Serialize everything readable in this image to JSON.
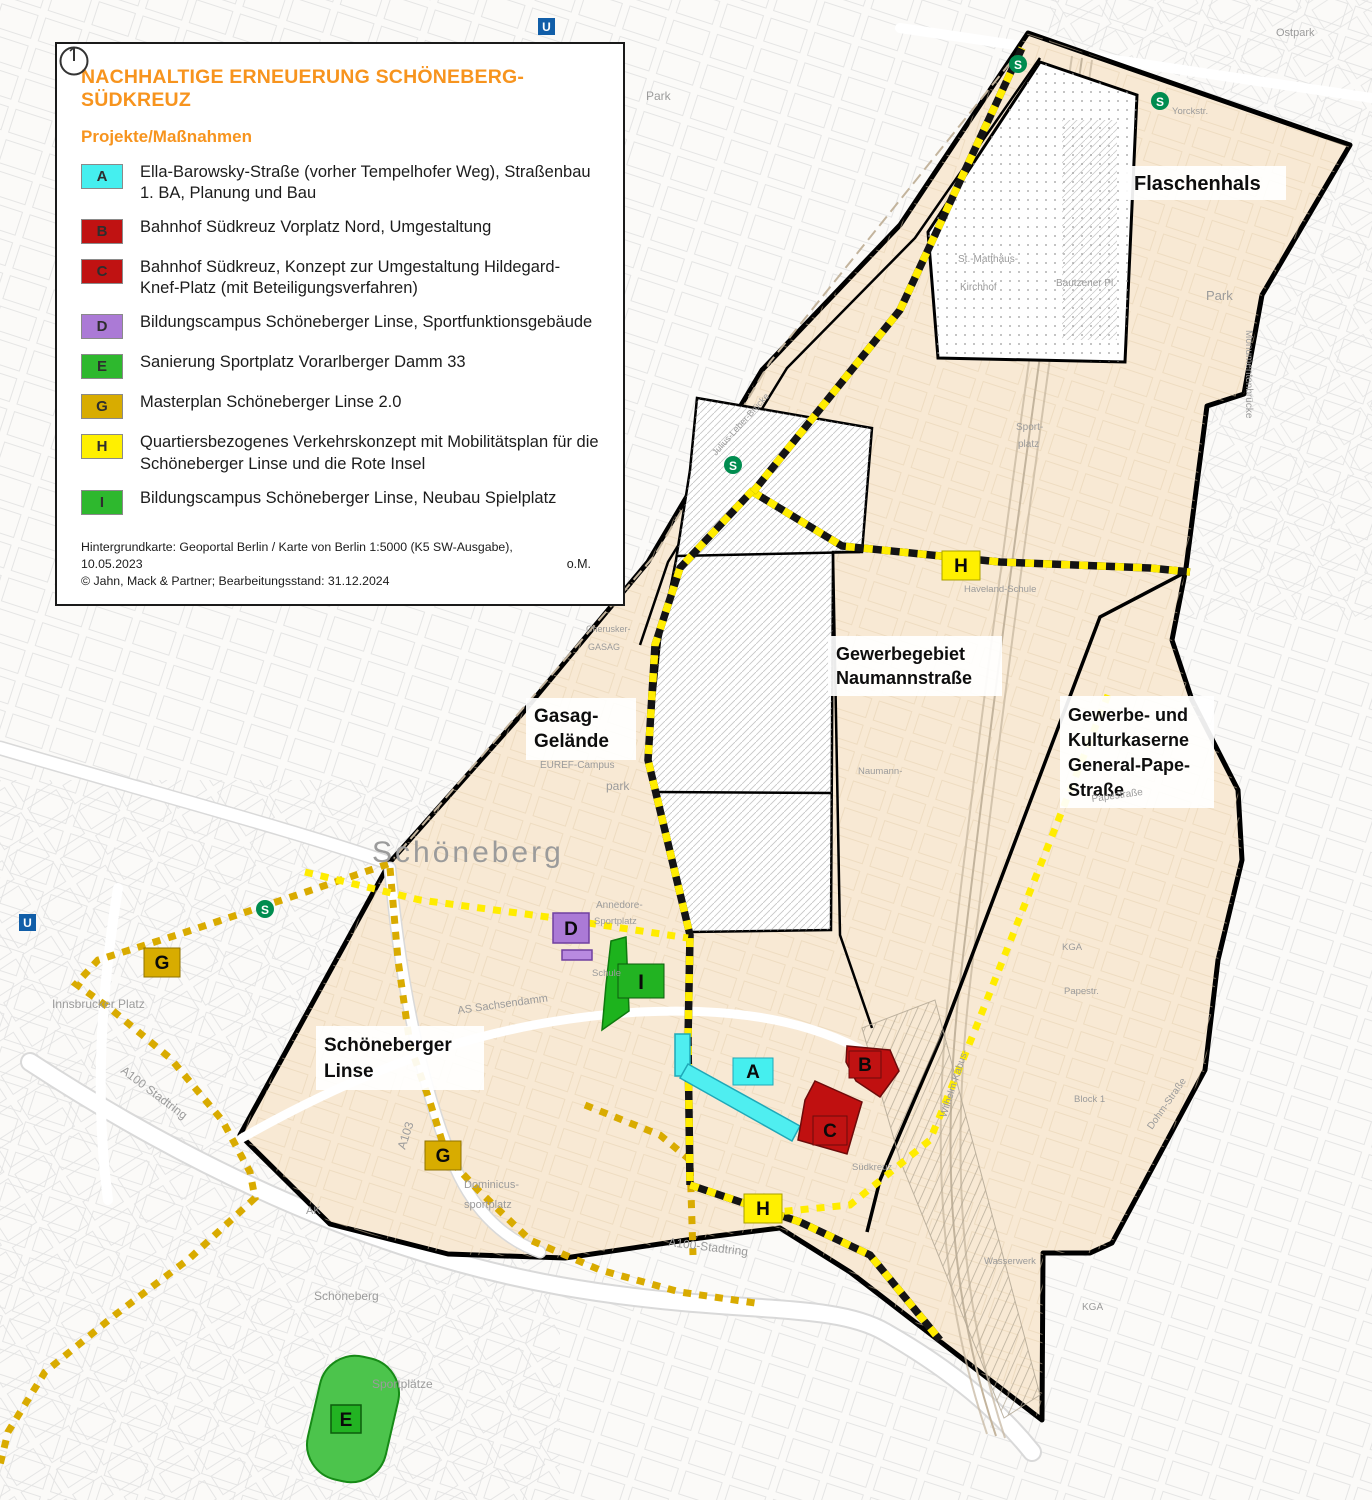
{
  "legend": {
    "title": "NACHHALTIGE ERNEUERUNG SCHÖNEBERG-SÜDKREUZ",
    "title_color": "#F7941E",
    "subtitle": "Projekte/Maßnahmen",
    "items": [
      {
        "letter": "A",
        "color": "#45EFEF",
        "label": "Ella-Barowsky-Straße (vorher Tempelhofer Weg), Straßenbau 1. BA, Planung und Bau"
      },
      {
        "letter": "B",
        "color": "#C01212",
        "label": "Bahnhof Südkreuz Vorplatz Nord, Umgestaltung"
      },
      {
        "letter": "C",
        "color": "#C01212",
        "label": "Bahnhof Südkreuz, Konzept zur Umgestaltung Hildegard-Knef-Platz (mit Beteiligungsverfahren)"
      },
      {
        "letter": "D",
        "color": "#AB7AD6",
        "label": "Bildungscampus Schöneberger Linse, Sportfunktionsgebäude"
      },
      {
        "letter": "E",
        "color": "#2EB82E",
        "label": "Sanierung Sportplatz Vorarlberger Damm 33"
      },
      {
        "letter": "G",
        "color": "#D8AC00",
        "label": "Masterplan Schöneberger Linse 2.0"
      },
      {
        "letter": "H",
        "color": "#FFF000",
        "label": "Quartiersbezogenes Verkehrskonzept mit Mobilitätsplan für die Schöneberger Linse und die Rote Insel"
      },
      {
        "letter": "I",
        "color": "#2EB82E",
        "label": "Bildungscampus Schöneberger Linse, Neubau Spielplatz"
      }
    ],
    "source_line1": "Hintergrundkarte: Geoportal Berlin / Karte von Berlin 1:5000 (K5 SW-Ausgabe), 10.05.2023",
    "source_line2": "© Jahn, Mack & Partner; Bearbeitungsstand: 31.12.2024",
    "scale_note": "o.M."
  },
  "map": {
    "area_labels": {
      "flaschenhals": "Flaschenhals",
      "naumann_line1": "Gewerbegebiet",
      "naumann_line2": "Naumannstraße",
      "kaserne_line1": "Gewerbe- und",
      "kaserne_line2": "Kulturkaserne",
      "kaserne_line3": "General-Pape-",
      "kaserne_line4": "Straße",
      "gasag_line1": "Gasag-",
      "gasag_line2": "Gelände",
      "linse_line1": "Schöneberger",
      "linse_line2": "Linse"
    },
    "markers": {
      "a": "A",
      "b": "B",
      "c": "C",
      "d": "D",
      "e": "E",
      "g": "G",
      "h": "H",
      "i": "I"
    },
    "marker_colors": {
      "a": "#45EFEF",
      "b": "#C01212",
      "c": "#C01212",
      "d": "#AB7AD6",
      "e": "#22B322",
      "g": "#D8AC00",
      "h": "#FFF000",
      "i": "#22B322"
    },
    "shape_colors": {
      "a_street": "#4FEEF0",
      "b_area": "#C01010",
      "c_area": "#C01010",
      "d_area": "#B88AE0",
      "e_field": "#4CC44C",
      "i_area": "#1DB31D"
    },
    "transit": {
      "s_label": "S",
      "u_label": "U"
    },
    "minor_labels": [
      "Schöneberg",
      "Park",
      "park",
      "EUREF-Campus",
      "St.-Matthäus-",
      "Kirchhof",
      "Bautzener Pl.",
      "Sport-",
      "platz",
      "Sportplatz",
      "Schule",
      "Haveland-Schule",
      "AS Sachsendamm",
      "A103",
      "A100 Stadtring",
      "A100-Stadtring",
      "Dominicus-",
      "sportplatz",
      "AK",
      "Innsbrucker Platz",
      "Sportplätze",
      "Schöneberg",
      "KGA",
      "Wasserwerk",
      "Papestraße",
      "Monumentenbrücke",
      "Südkreuz",
      "Wilhelm-Kabus-",
      "Dohm-Straße",
      "Naumann-",
      "Cherusker-",
      "GASAG",
      "B1",
      "Heinrich-Lassen-Park",
      "Yorckstr.",
      "Ostpark",
      "Park",
      "Annedore-",
      "Julius-Leber-Brücke",
      "KGA",
      "Papestr.",
      "Block 1"
    ]
  }
}
